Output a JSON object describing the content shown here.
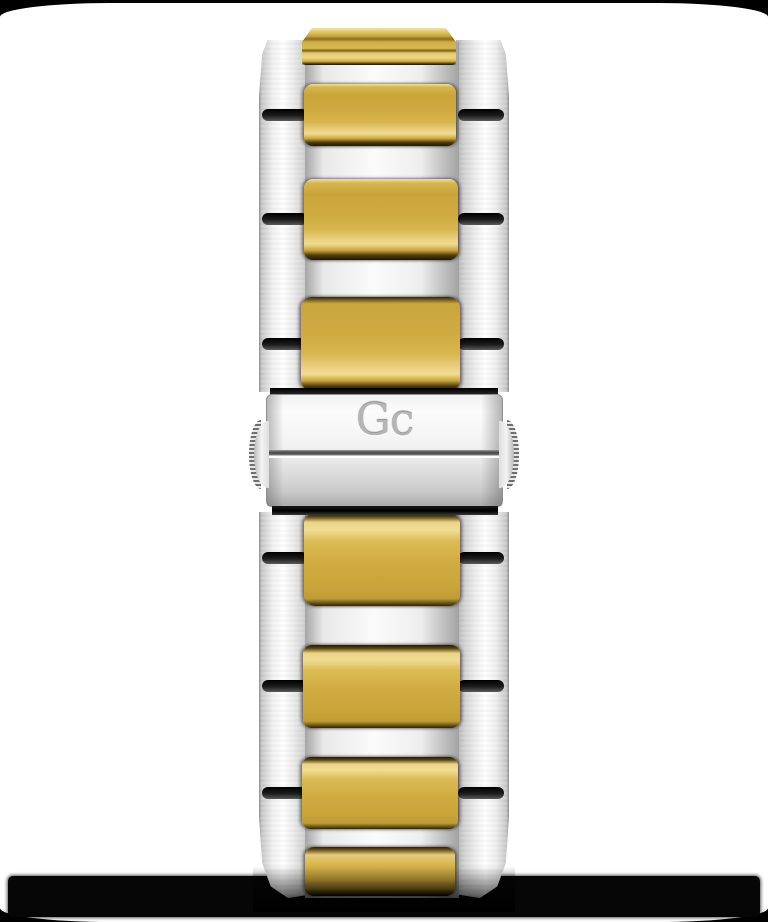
{
  "product": {
    "brand_logo": "Gc",
    "description": "Two-tone stainless steel watch bracelet with brushed gold center links and engraved fold-over clasp, shown from the clasp side on a white background with black rounded-corner frame"
  },
  "colors": {
    "frame_black": "#000000",
    "background_white": "#ffffff",
    "gold_base": "#cfab41",
    "gold_highlight": "#f0dc94",
    "gold_shadow": "#1f1605",
    "steel_highlight": "#ffffff",
    "steel_base": "#e9e9e9",
    "steel_edge": "#8f8f8f",
    "slot_black": "#111111",
    "shadow_band": "#060606",
    "engraving_gray": "#b5b5b5"
  }
}
